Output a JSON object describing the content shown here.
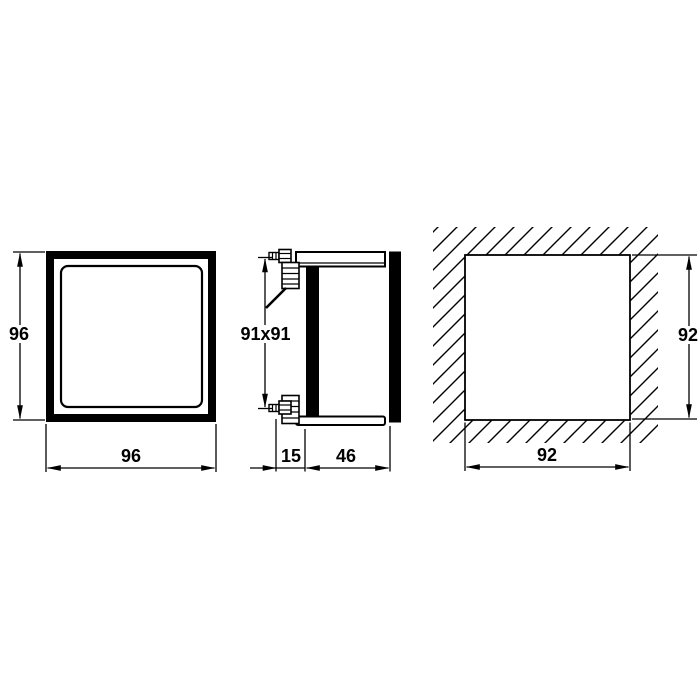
{
  "views": {
    "front": {
      "height": "96",
      "width": "96"
    },
    "side": {
      "cutout": "91x91",
      "terminal_clearance": "15",
      "mounting_depth": "46"
    },
    "panel_cutout": {
      "height": "92",
      "width": "92"
    }
  },
  "colors": {
    "line": "#000000",
    "solid_fill": "#000000",
    "background": "#ffffff"
  }
}
